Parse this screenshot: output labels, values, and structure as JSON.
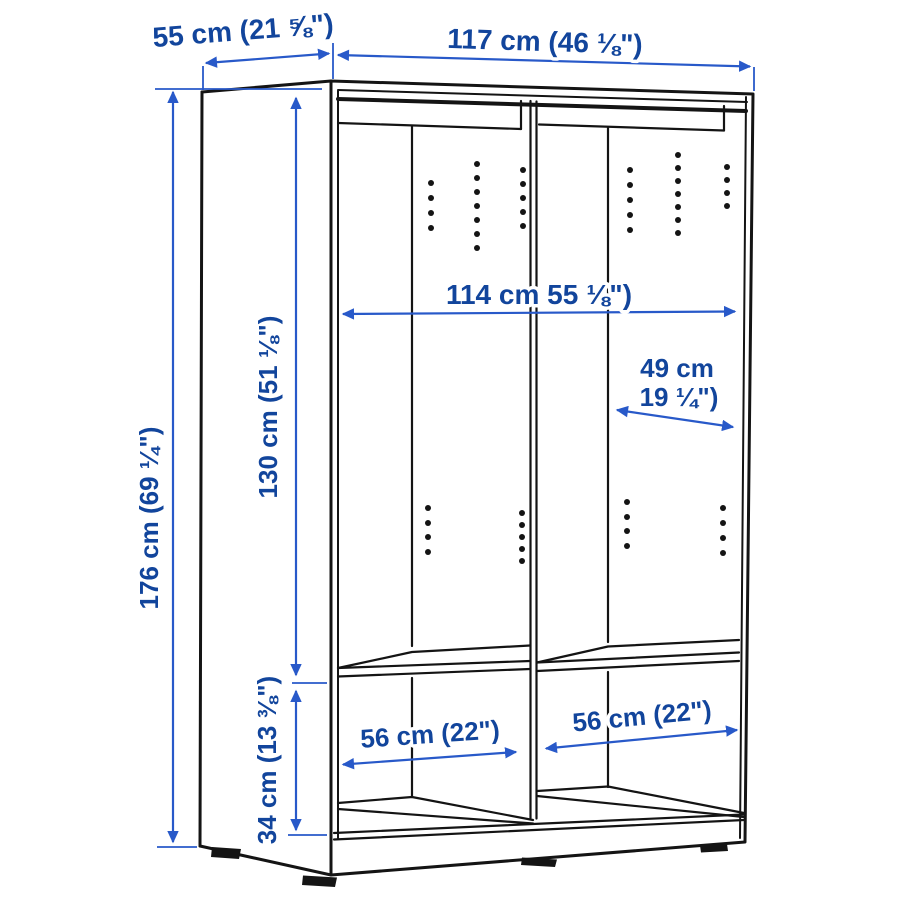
{
  "page": {
    "background": "#ffffff",
    "description": "Wardrobe with sliding doors - line drawing with measurements"
  },
  "diagram": {
    "colors": {
      "dimension_text": "#12459C",
      "dimension_line": "#2859C9",
      "drawing_line": "#141414"
    },
    "dimensions": {
      "depth_top": {
        "label": "55 cm (21 ⅝\")"
      },
      "width_top": {
        "label": "117 cm (46 ⅛\")"
      },
      "height_left": {
        "label": "176 cm (69 ¼\")"
      },
      "interior_height_upper": {
        "label": "130 cm (51 ⅛\")"
      },
      "interior_width": {
        "label": "114 cm 55 ⅛\")"
      },
      "interior_depth_line1": {
        "label": "49 cm"
      },
      "interior_depth_line2": {
        "label": "19 ¼\")"
      },
      "interior_height_lower": {
        "label": "34 cm (13 ⅜\")"
      },
      "compartment_width_left": {
        "label": "56 cm (22\")"
      },
      "compartment_width_right": {
        "label": "56 cm (22\")"
      }
    }
  }
}
